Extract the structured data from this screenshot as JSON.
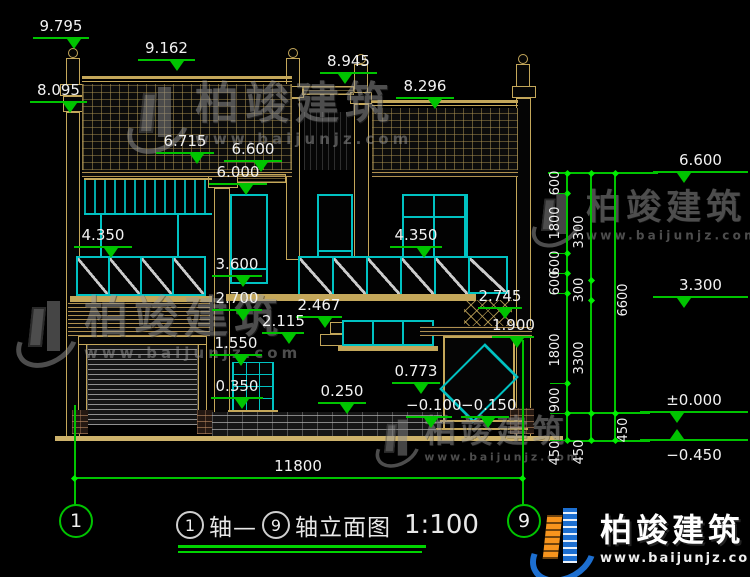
{
  "drawing_title": {
    "axis_from": "1",
    "axis_mid": "轴—",
    "axis_to": "9",
    "suffix": "轴立面图",
    "scale": "1:100"
  },
  "axis_bubbles": [
    {
      "label": "1",
      "cx": 74,
      "cy": 519
    },
    {
      "label": "9",
      "cx": 522,
      "cy": 519
    }
  ],
  "bottom_dimension": {
    "label": "11800",
    "x1": 74,
    "x2": 522,
    "y": 477
  },
  "elevation_marks": [
    {
      "t": "9.795",
      "x": 33,
      "y": 38,
      "w": 56,
      "tx": 34
    },
    {
      "t": "9.162",
      "x": 138,
      "y": 60,
      "w": 57,
      "tx": 32
    },
    {
      "t": "8.095",
      "x": 30,
      "y": 102,
      "w": 57,
      "tx": 33
    },
    {
      "t": "8.945",
      "x": 320,
      "y": 73,
      "w": 57,
      "tx": 18
    },
    {
      "t": "8.296",
      "x": 396,
      "y": 98,
      "w": 58,
      "tx": 32
    },
    {
      "t": "6.715",
      "x": 156,
      "y": 153,
      "w": 58,
      "tx": 34
    },
    {
      "t": "6.600",
      "x": 224,
      "y": 161,
      "w": 58,
      "tx": 30
    },
    {
      "t": "6.000",
      "x": 209,
      "y": 184,
      "w": 58,
      "tx": 30
    },
    {
      "t": "4.350",
      "x": 74,
      "y": 247,
      "w": 58,
      "tx": 30
    },
    {
      "t": "4.350",
      "x": 390,
      "y": 247,
      "w": 52,
      "tx": 27
    },
    {
      "t": "3.600",
      "x": 212,
      "y": 276,
      "w": 50,
      "tx": 24
    },
    {
      "t": "2.700",
      "x": 212,
      "y": 310,
      "w": 50,
      "tx": 24
    },
    {
      "t": "2.745",
      "x": 478,
      "y": 308,
      "w": 44,
      "tx": 20
    },
    {
      "t": "2.467",
      "x": 296,
      "y": 317,
      "w": 46,
      "tx": 22
    },
    {
      "t": "2.115",
      "x": 262,
      "y": 333,
      "w": 42,
      "tx": 20
    },
    {
      "t": "1.550",
      "x": 210,
      "y": 355,
      "w": 52,
      "tx": 24
    },
    {
      "t": "1.900",
      "x": 492,
      "y": 337,
      "w": 42,
      "tx": 18
    },
    {
      "t": "0.773",
      "x": 392,
      "y": 383,
      "w": 48,
      "tx": 22
    },
    {
      "t": "0.350",
      "x": 211,
      "y": 398,
      "w": 52,
      "tx": 24
    },
    {
      "t": "0.250",
      "x": 318,
      "y": 403,
      "w": 48,
      "tx": 22
    },
    {
      "t": "−0.100",
      "x": 406,
      "y": 417,
      "w": 46,
      "tx": 18
    },
    {
      "t": "−0.150",
      "x": 461,
      "y": 417,
      "w": 48,
      "tx": 20
    },
    {
      "t": "6.600",
      "x": 653,
      "y": 172,
      "w": 95,
      "tx": 24
    },
    {
      "t": "3.300",
      "x": 653,
      "y": 297,
      "w": 95,
      "tx": 24
    },
    {
      "t": "±0.000",
      "x": 640,
      "y": 412,
      "w": 108,
      "tx": 30
    },
    {
      "t": "−0.450",
      "x": 640,
      "y": 440,
      "w": 108,
      "tx": 30,
      "dir": "up"
    }
  ],
  "dim_chains": {
    "columns": [
      {
        "x": 566,
        "lx": -10,
        "ext": true,
        "ticks": [
          173,
          193,
          253,
          273,
          293,
          383,
          413,
          440
        ],
        "labels": [
          {
            "t": "600",
            "cy": 183
          },
          {
            "t": "1800",
            "cy": 223
          },
          {
            "t": "600",
            "cy": 263
          },
          {
            "t": "600",
            "cy": 283
          },
          {
            "t": "1800",
            "cy": 350
          },
          {
            "t": "900",
            "cy": 400
          },
          {
            "t": "450",
            "cy": 453
          }
        ]
      },
      {
        "x": 590,
        "lx": -10,
        "ticks": [
          173,
          280,
          300,
          413,
          440
        ],
        "labels": [
          {
            "t": "3300",
            "cy": 232
          },
          {
            "t": "300",
            "cy": 290
          },
          {
            "t": "3300",
            "cy": 358
          },
          {
            "t": "450",
            "cy": 452
          }
        ]
      },
      {
        "x": 614,
        "lx": 10,
        "ticks": [
          173,
          413,
          440
        ],
        "labels": [
          {
            "t": "6600",
            "cy": 300
          },
          {
            "t": "450",
            "cy": 430
          }
        ]
      }
    ]
  },
  "green_lines": [
    {
      "x": 74,
      "y": 405,
      "w": 2,
      "h": 100
    },
    {
      "x": 522,
      "y": 340,
      "w": 2,
      "h": 165
    },
    {
      "x": 548,
      "y": 172,
      "w": 110,
      "h": 2
    },
    {
      "x": 566,
      "y": 412,
      "w": 84,
      "h": 2
    },
    {
      "x": 566,
      "y": 440,
      "w": 84,
      "h": 2
    }
  ],
  "watermark": {
    "brand": "柏竣建筑",
    "url": "www.baijunjz.com"
  },
  "watermarks": [
    {
      "x": 125,
      "y": 82,
      "scale": 1
    },
    {
      "x": 14,
      "y": 296,
      "scale": 1
    },
    {
      "x": 530,
      "y": 190,
      "scale": 0.8
    },
    {
      "x": 374,
      "y": 416,
      "scale": 0.72
    }
  ],
  "logo": {
    "brand": "柏竣建筑",
    "url": "www.baijunjz.com"
  }
}
